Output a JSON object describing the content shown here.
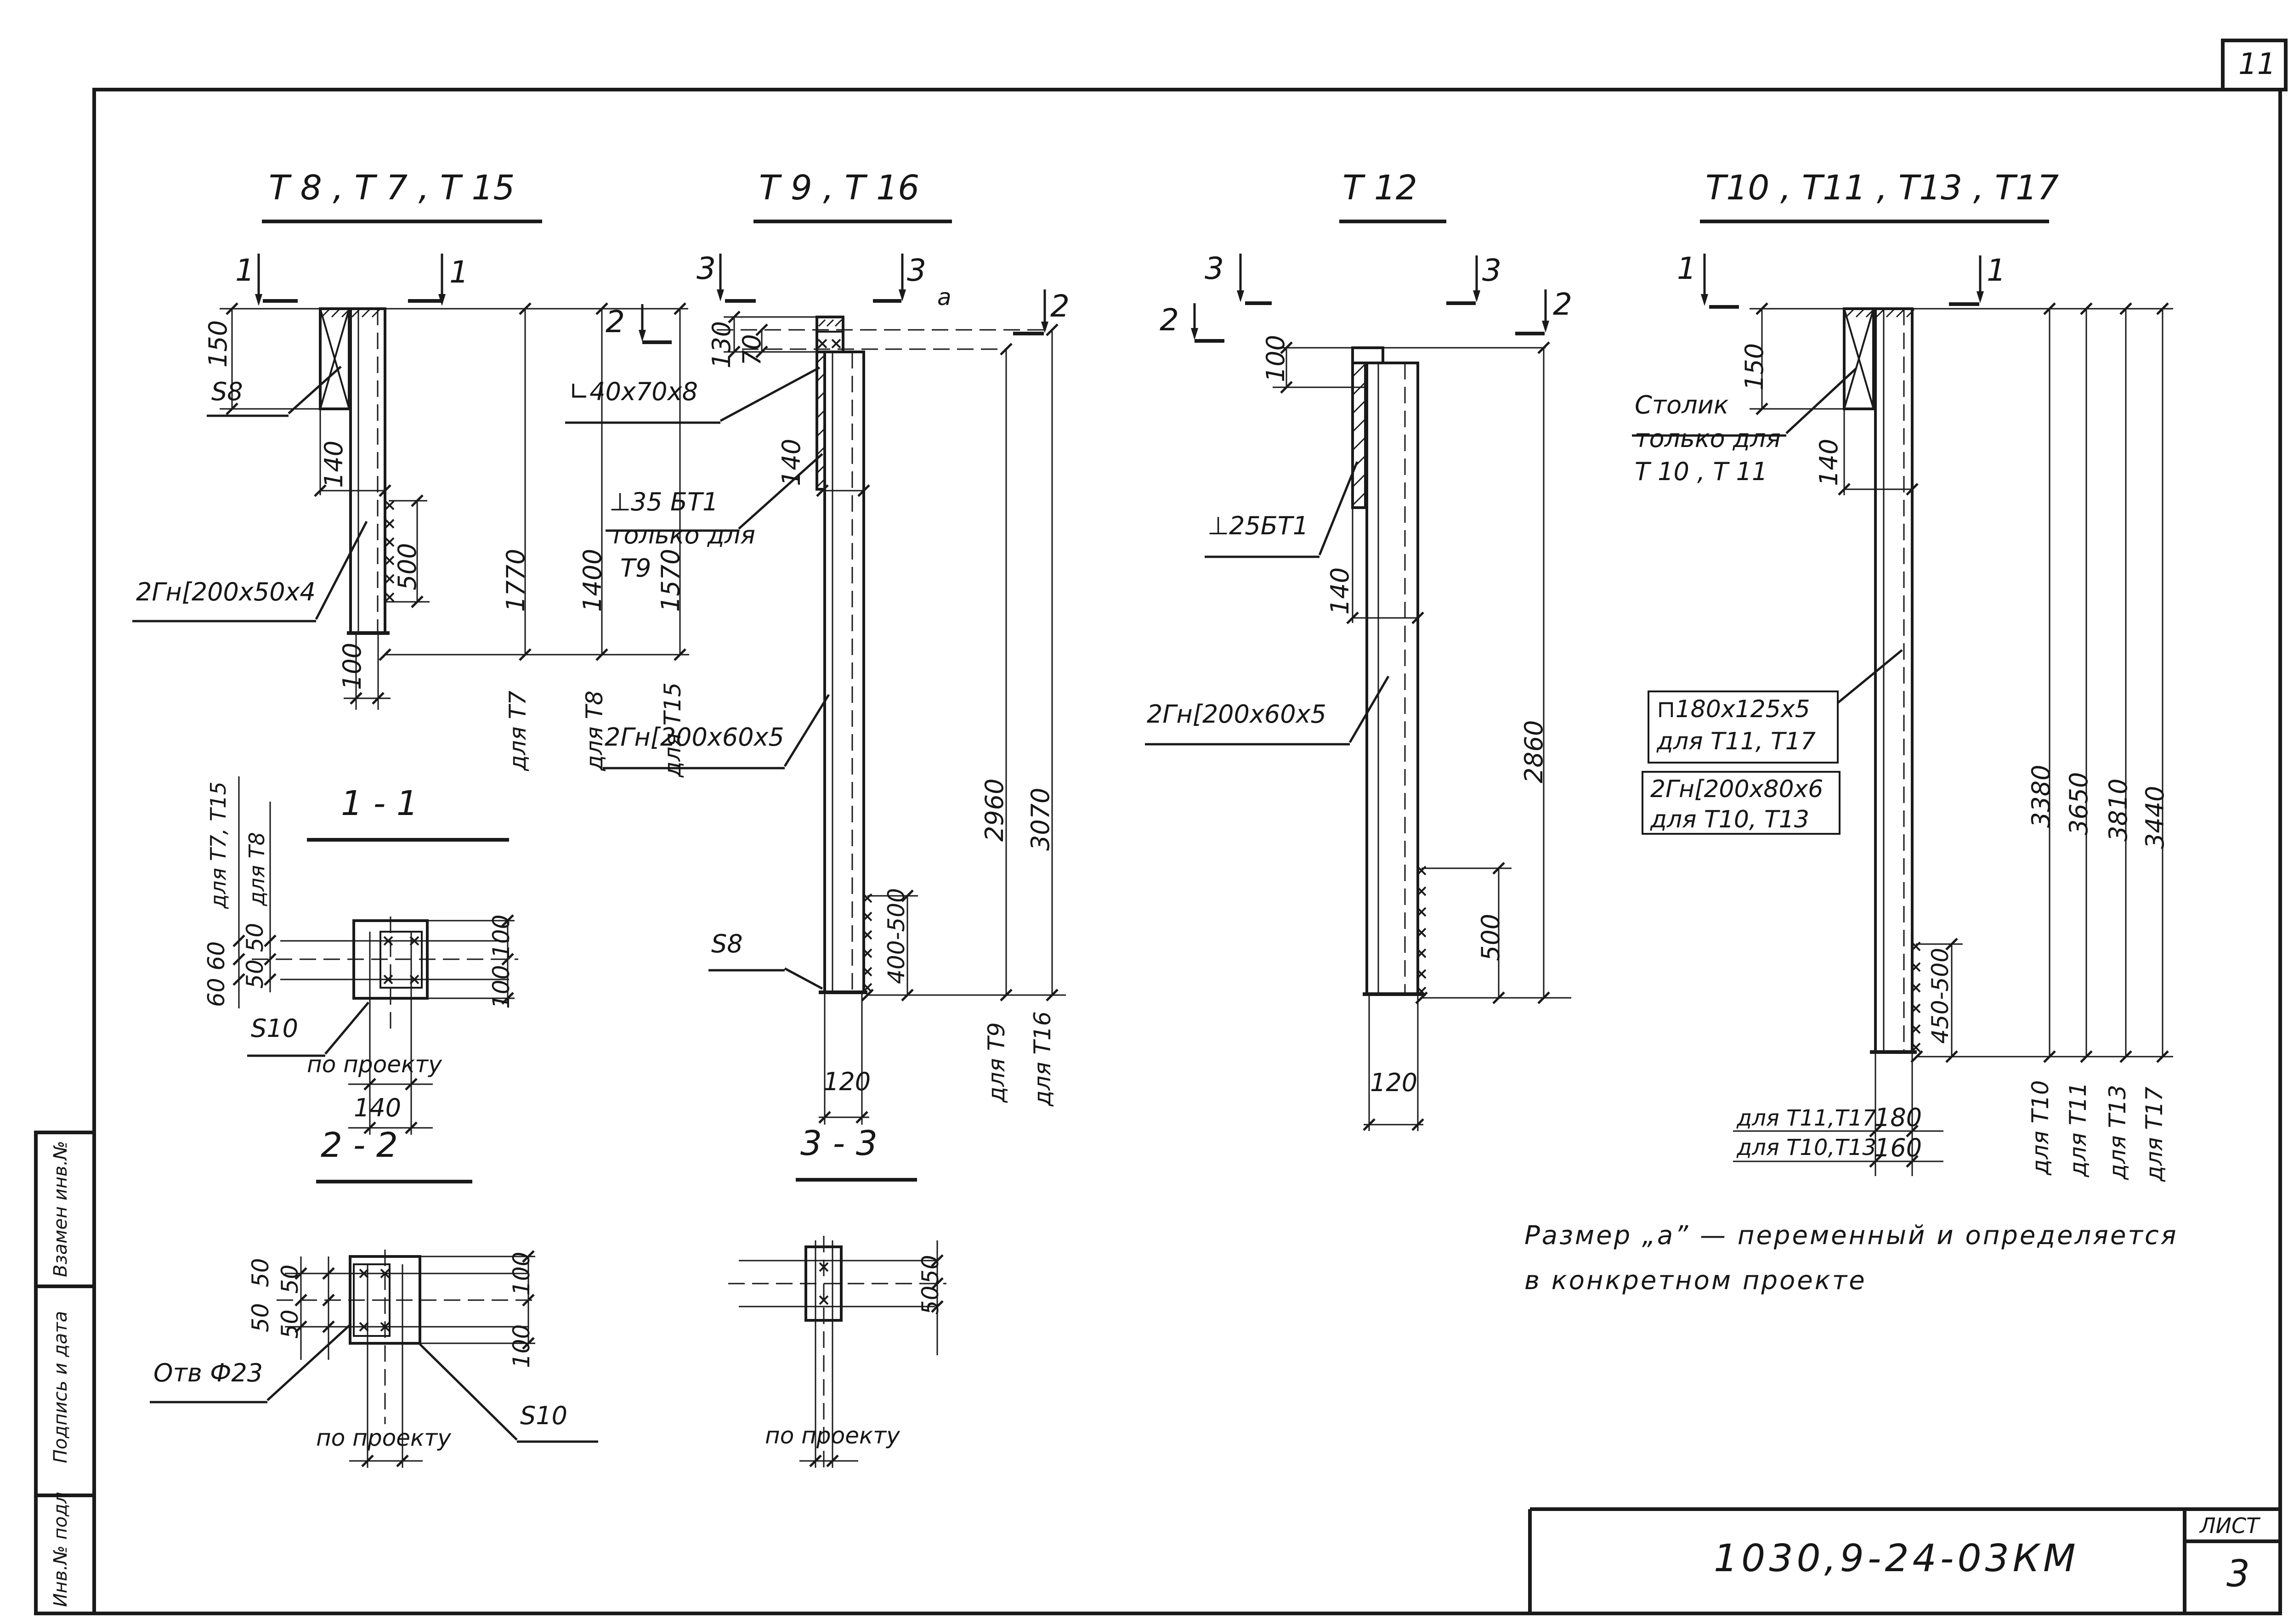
{
  "page": {
    "number": "11",
    "sheet_label": "ЛИСТ",
    "sheet_number": "3",
    "stamp_code": "1030,9-24-03КМ",
    "note_line1": "Размер „а” — переменный и определяется",
    "note_line2": "в конкретном проекте",
    "sidebar_1": "Взамен инв.№",
    "sidebar_2": "Подпись и дата",
    "sidebar_3": "Инв.№ подл"
  },
  "g1": {
    "title": "Т 8 , Т 7 , Т 15",
    "mark_1l": "1",
    "mark_1r": "1",
    "dim150": "150",
    "dim140": "140",
    "dim500": "500",
    "dim100": "100",
    "dim1770": "1770",
    "dim1400": "1400",
    "dim1570": "1570",
    "for_t7": "для Т7",
    "for_t8": "для Т8",
    "for_t15": "для Т15",
    "label_s8": "S8",
    "label_channel": "2Гн[200х50х4"
  },
  "s11": {
    "title": "1 - 1",
    "for_t7_t15": "для Т7, Т15",
    "dim_60_60": "60 60",
    "for_t8": "для Т8",
    "dim_50_50": "50 50",
    "dim_100_top": "100",
    "dim_100_bot": "100",
    "label_s10": "S10",
    "project": "по проекту",
    "dim140": "140"
  },
  "s22": {
    "title": "2 - 2",
    "d50": [
      "50",
      "50",
      "50",
      "50"
    ],
    "dim_100_top": "100",
    "dim_100_bot": "100",
    "label_hole": "Отв Ф23",
    "label_s10": "S10",
    "project": "по проекту"
  },
  "g2": {
    "title": "Т 9 , Т 16",
    "mark_3l": "3",
    "mark_3r": "3",
    "mark_2l": "2",
    "mark_2r": "2",
    "dim_a": "а",
    "dim130": "130",
    "dim70": "70",
    "dim140": "140",
    "dim120": "120",
    "label_angle": "∟40х70х8",
    "label_bt35": "⊥35 БТ1",
    "only_for": "только для",
    "t9": "Т9",
    "label_channel": "2Гн[200х60х5",
    "label_s8": "S8",
    "dim400500": "400-500",
    "dim2960": "2960",
    "dim3070": "3070",
    "for_t9": "для Т9",
    "for_t16": "для Т16"
  },
  "s33": {
    "title": "3 - 3",
    "d50a": "50",
    "d50b": "50",
    "project": "по проекту"
  },
  "g3": {
    "title": "Т 12",
    "mark_3l": "3",
    "mark_3r": "3",
    "mark_2l": "2",
    "mark_2r": "2",
    "dim100": "100",
    "dim140": "140",
    "dim500": "500",
    "dim2860": "2860",
    "dim120": "120",
    "label_bt25": "⊥25БТ1",
    "label_channel": "2Гн[200х60х5"
  },
  "g4": {
    "title": "Т10 , Т11 , Т13 , Т17",
    "mark_1l": "1",
    "mark_1r": "1",
    "dim150": "150",
    "dim140": "140",
    "dim450500": "450-500",
    "stolik": "Столик",
    "only_for": "только для",
    "t10_t11": "Т 10 , Т 11",
    "label_plate": "⊓180х125х5",
    "plate_for": "для Т11, Т17",
    "label_channel": "2Гн[200х80х6",
    "channel_for": "для Т10, Т13",
    "dim3380": "3380",
    "dim3650": "3650",
    "dim3810": "3810",
    "dim3440": "3440",
    "for_t10": "для Т10",
    "for_t11": "для Т11",
    "for_t13": "для Т13",
    "for_t17": "для Т17",
    "tbl_r1_label": "для Т11,Т17",
    "tbl_r1_val": "180",
    "tbl_r2_label": "для Т10,Т13",
    "tbl_r2_val": "160"
  }
}
